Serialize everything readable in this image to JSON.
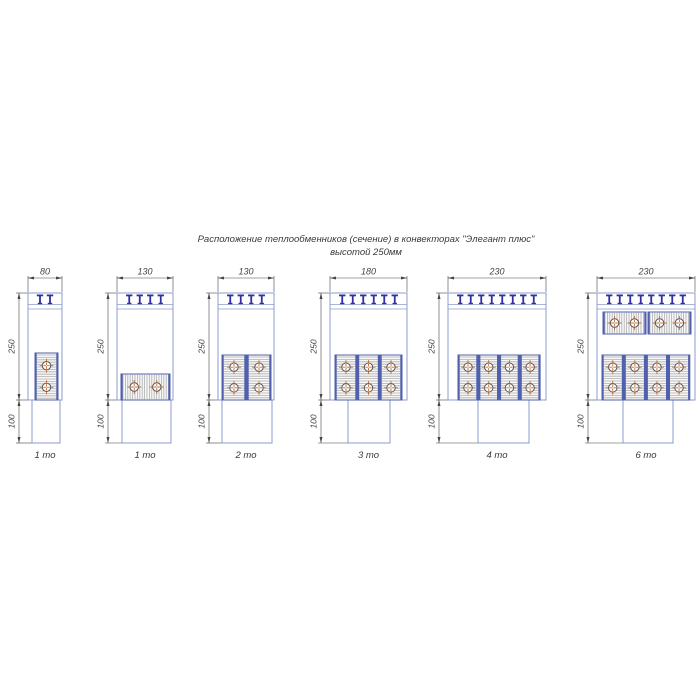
{
  "title": {
    "line1": "Расположение теплообменников (сечение) в конвекторах \"Элегант плюс\"",
    "line2": "высотой 250мм"
  },
  "colors": {
    "outline": "#8d9bce",
    "exchanger_border": "#5060ae",
    "clip": "#30309c",
    "hatch_line": "#b0b0b0",
    "hatch_bg": "#f7f7f7",
    "tube_outline": "#5a5248",
    "tube_cross": "#bf6b3a",
    "dimension": "#454545",
    "text": "#3a3a3a",
    "background": "#ffffff"
  },
  "convectors": [
    {
      "type_label": "1 то",
      "width_label": "80",
      "height_label": "250",
      "lower_height_label": "100",
      "clips": 2,
      "box": {
        "left": 28,
        "width": 34
      },
      "lower_box": {
        "offset": 4,
        "width": 28
      },
      "exchangers": [
        {
          "o": "v",
          "x": 7,
          "y": 60,
          "w": 23,
          "h": 47
        }
      ]
    },
    {
      "type_label": "1 то",
      "width_label": "130",
      "height_label": "250",
      "lower_height_label": "100",
      "clips": 4,
      "box": {
        "left": 117,
        "width": 56
      },
      "lower_box": {
        "offset": 5,
        "width": 49
      },
      "exchangers": [
        {
          "o": "h",
          "x": 4,
          "y": 81,
          "w": 49,
          "h": 26
        }
      ]
    },
    {
      "type_label": "2 то",
      "width_label": "130",
      "height_label": "250",
      "lower_height_label": "100",
      "clips": 4,
      "box": {
        "left": 218,
        "width": 56
      },
      "lower_box": {
        "offset": 4,
        "width": 50
      },
      "exchangers": [
        {
          "o": "v",
          "x": 4,
          "y": 62,
          "w": 24,
          "h": 45
        },
        {
          "o": "v",
          "x": 29,
          "y": 62,
          "w": 24,
          "h": 45
        }
      ]
    },
    {
      "type_label": "3 то",
      "width_label": "180",
      "height_label": "250",
      "lower_height_label": "100",
      "clips": 6,
      "box": {
        "left": 330,
        "width": 77
      },
      "lower_box": {
        "offset": 18,
        "width": 42
      },
      "exchangers": [
        {
          "o": "v",
          "x": 5,
          "y": 62,
          "w": 22,
          "h": 45
        },
        {
          "o": "v",
          "x": 27.5,
          "y": 62,
          "w": 22,
          "h": 45
        },
        {
          "o": "v",
          "x": 50,
          "y": 62,
          "w": 22,
          "h": 45
        }
      ]
    },
    {
      "type_label": "4 то",
      "width_label": "230",
      "height_label": "250",
      "lower_height_label": "100",
      "clips": 8,
      "box": {
        "left": 448,
        "width": 98
      },
      "lower_box": {
        "offset": 30,
        "width": 51
      },
      "exchangers": [
        {
          "o": "v",
          "x": 10,
          "y": 62,
          "w": 20,
          "h": 45
        },
        {
          "o": "v",
          "x": 30.7,
          "y": 62,
          "w": 20,
          "h": 45
        },
        {
          "o": "v",
          "x": 51.4,
          "y": 62,
          "w": 20,
          "h": 45
        },
        {
          "o": "v",
          "x": 72.1,
          "y": 62,
          "w": 20,
          "h": 45
        }
      ]
    },
    {
      "type_label": "6 то",
      "width_label": "230",
      "height_label": "250",
      "lower_height_label": "100",
      "clips": 8,
      "box": {
        "left": 597,
        "width": 98
      },
      "lower_box": {
        "offset": 26,
        "width": 50
      },
      "exchangers": [
        {
          "o": "h",
          "x": 6,
          "y": 19,
          "w": 43,
          "h": 22
        },
        {
          "o": "h",
          "x": 51,
          "y": 19,
          "w": 43,
          "h": 22
        },
        {
          "o": "v",
          "x": 5,
          "y": 62,
          "w": 21.5,
          "h": 45
        },
        {
          "o": "v",
          "x": 27.1,
          "y": 62,
          "w": 21.5,
          "h": 45
        },
        {
          "o": "v",
          "x": 49.2,
          "y": 62,
          "w": 21.5,
          "h": 45
        },
        {
          "o": "v",
          "x": 71.3,
          "y": 62,
          "w": 21.5,
          "h": 45
        }
      ]
    }
  ]
}
